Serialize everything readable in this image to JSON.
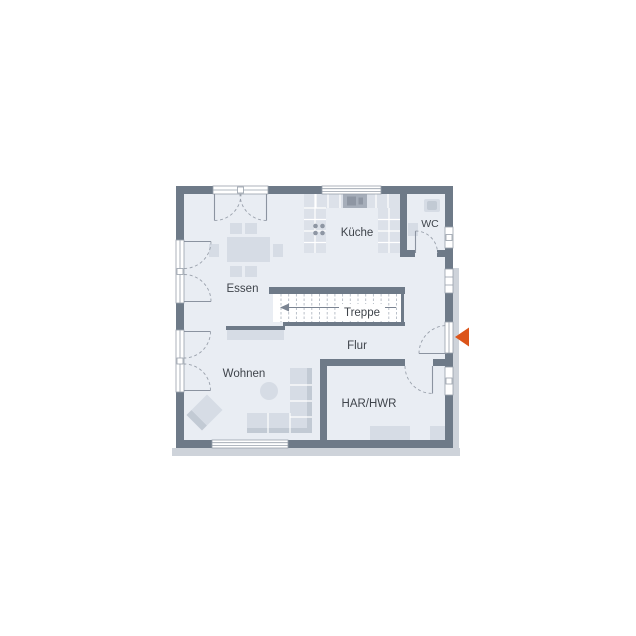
{
  "plan": {
    "title": "floor-plan-ground-floor",
    "rooms": {
      "essen": {
        "label": "Essen"
      },
      "kueche": {
        "label": "Küche"
      },
      "wc": {
        "label": "WC"
      },
      "treppe": {
        "label": "Treppe"
      },
      "flur": {
        "label": "Flur"
      },
      "wohnen": {
        "label": "Wohnen"
      },
      "har_hwr": {
        "label": "HAR/HWR"
      }
    },
    "entrance": {
      "marker": "orange-arrow-left"
    },
    "colors": {
      "wall": "#6e7a88",
      "floor": "#e9edf3",
      "furniture": "#d6dce5",
      "furniture_dark": "#c2cad4",
      "counter": "#dce1e9",
      "appliance": "#a6aeba",
      "appliance_dark": "#8e96a3",
      "accent": "#dc541a",
      "text": "#3f444b",
      "shadow": "#ced3da",
      "frame": "#98a0ab"
    }
  }
}
